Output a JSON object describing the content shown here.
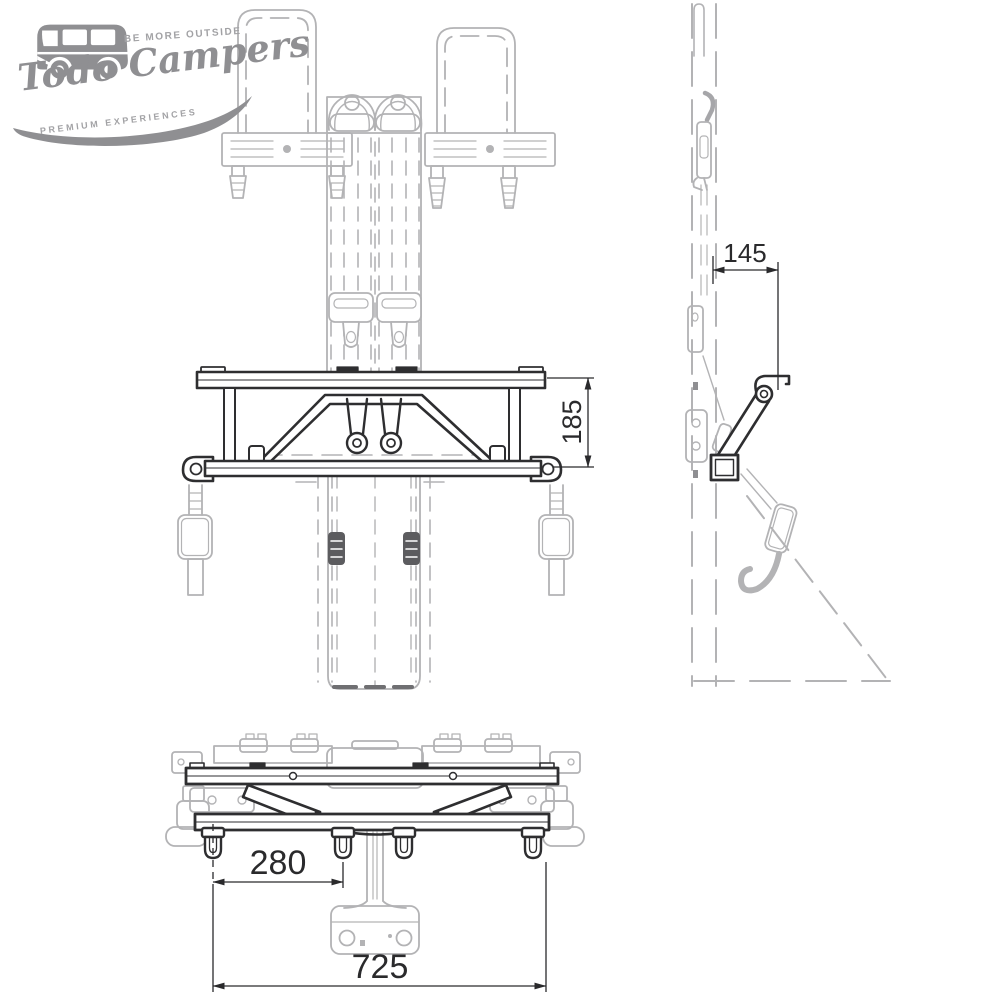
{
  "logo": {
    "tagline_top": "BE MORE OUTSIDE",
    "brand": "Todo Campers",
    "tagline_bottom": "PREMIUM EXPERIENCES",
    "color": "#8f8f92"
  },
  "drawing": {
    "type": "technical-drawing-3-views",
    "subject": "seat-belt mounting bracket with belts and headrest frames",
    "dimensions": {
      "side_offset": "145",
      "plan_depth": "185",
      "hook_spacing": "280",
      "overall_width": "725"
    },
    "colors": {
      "product_line": "#2e2e30",
      "reference_line": "#b3b3b5",
      "dimension_line": "#2a2a2c"
    }
  }
}
